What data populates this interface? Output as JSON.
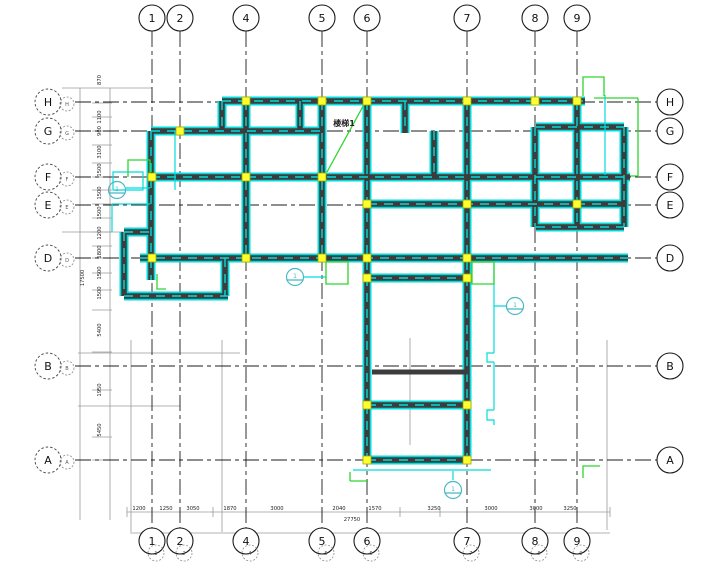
{
  "drawing": {
    "labels": {
      "stair": "楼梯1",
      "marker": "1",
      "total_bottom": "27750",
      "total_left": "17500"
    },
    "colors": {
      "wall_core": "#3c3c3c",
      "wall_edge": "#00dcdc",
      "column": "#ffff2e",
      "annotation": "#2fd52f",
      "marker": "#49b8c4",
      "grid": "#1c1c1c",
      "construction": "#9a9a9a"
    },
    "axes": {
      "cols": [
        {
          "label": "1",
          "x": 152
        },
        {
          "label": "2",
          "x": 180
        },
        {
          "label": "4",
          "x": 246
        },
        {
          "label": "5",
          "x": 322
        },
        {
          "label": "6",
          "x": 367
        },
        {
          "label": "7",
          "x": 467
        },
        {
          "label": "8",
          "x": 535
        },
        {
          "label": "9",
          "x": 577
        }
      ],
      "rows": [
        {
          "label": "H",
          "y": 102
        },
        {
          "label": "G",
          "y": 131
        },
        {
          "label": "F",
          "y": 177
        },
        {
          "label": "E",
          "y": 205
        },
        {
          "label": "D",
          "y": 258
        },
        {
          "label": "B",
          "y": 366
        },
        {
          "label": "A",
          "y": 460
        }
      ]
    },
    "columns_px": [
      [
        246,
        101
      ],
      [
        322,
        101
      ],
      [
        367,
        101
      ],
      [
        467,
        101
      ],
      [
        535,
        101
      ],
      [
        577,
        101
      ],
      [
        180,
        131
      ],
      [
        152,
        177
      ],
      [
        246,
        177
      ],
      [
        322,
        177
      ],
      [
        367,
        204
      ],
      [
        467,
        204
      ],
      [
        577,
        204
      ],
      [
        152,
        258
      ],
      [
        246,
        258
      ],
      [
        322,
        258
      ],
      [
        367,
        258
      ],
      [
        467,
        258
      ],
      [
        367,
        278
      ],
      [
        467,
        278
      ],
      [
        367,
        405
      ],
      [
        467,
        405
      ],
      [
        367,
        460
      ],
      [
        467,
        460
      ]
    ],
    "markers": [
      {
        "x": 117,
        "y": 190
      },
      {
        "x": 295,
        "y": 277
      },
      {
        "x": 515,
        "y": 306
      },
      {
        "x": 453,
        "y": 490
      }
    ],
    "dims_bottom": [
      {
        "v": "1200",
        "x": 139
      },
      {
        "v": "1250",
        "x": 166
      },
      {
        "v": "3050",
        "x": 193
      },
      {
        "v": "1870",
        "x": 230
      },
      {
        "v": "3000",
        "x": 277
      },
      {
        "v": "2040",
        "x": 339
      },
      {
        "v": "1570",
        "x": 375
      },
      {
        "v": "3250",
        "x": 434
      },
      {
        "v": "3000",
        "x": 491
      },
      {
        "v": "3000",
        "x": 536
      },
      {
        "v": "3250",
        "x": 570
      }
    ],
    "dims_left": [
      {
        "v": "870",
        "y": 80
      },
      {
        "v": "1100",
        "y": 117
      },
      {
        "v": "900",
        "y": 131
      },
      {
        "v": "3100",
        "y": 152
      },
      {
        "v": "1500",
        "y": 170
      },
      {
        "v": "1500",
        "y": 193
      },
      {
        "v": "1500",
        "y": 213
      },
      {
        "v": "1200",
        "y": 233
      },
      {
        "v": "1800",
        "y": 252
      },
      {
        "v": "1500",
        "y": 273
      },
      {
        "v": "1500",
        "y": 293
      },
      {
        "v": "5400",
        "y": 330
      },
      {
        "v": "1950",
        "y": 390
      },
      {
        "v": "5450",
        "y": 430
      }
    ]
  }
}
